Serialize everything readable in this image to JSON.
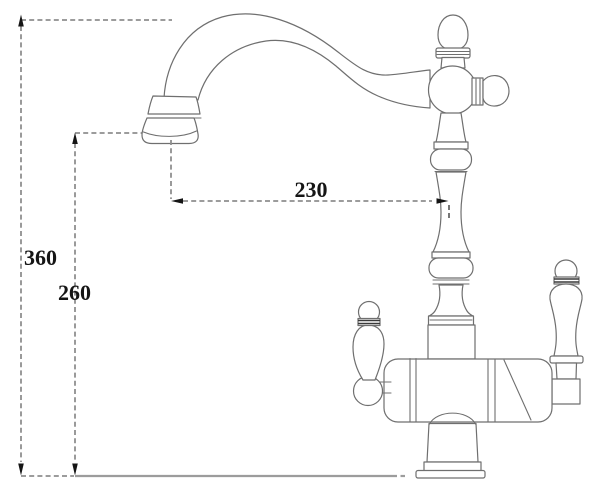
{
  "meta": {
    "subject": "faucet-dimension-drawing"
  },
  "dims": {
    "overall_height": "360",
    "spout_outlet_height": "260",
    "spout_reach": "230"
  },
  "colors": {
    "background": "#ffffff",
    "outline": "#6f6f6f",
    "dimension_line": "#8f8f8f",
    "dimension_text": "#151515",
    "arrow": "#151515",
    "counter_line": "#9c9c9c"
  }
}
